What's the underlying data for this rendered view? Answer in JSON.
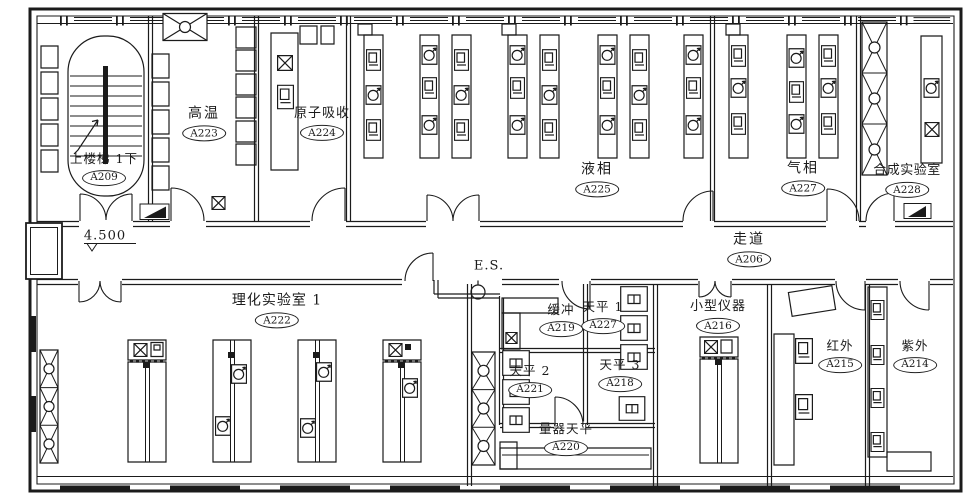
{
  "plan": {
    "colors": {
      "line": "#1b1b1b",
      "background": "#ffffff"
    },
    "annotations": {
      "elevation": "4.500",
      "exit_sign": "E.S."
    },
    "icons": {
      "door": "quarter-arc-swing",
      "stairs": "parallel-tread-run-with-up-arrow",
      "fume_hood_column": "x-hatch-column-with-circles",
      "instrument_dial": "circle-gauge-with-arrow",
      "instrument_box": "small-cabinet-box",
      "balance_table": "box-with-inner-square",
      "floor_drain": "x-box",
      "window_band": "triple-line-glazing-strip",
      "air_handler": "x-rect-with-center-circle",
      "exit_light": "circle-on-stem",
      "elevation_marker": "underline-with-open-triangle"
    },
    "rooms": [
      {
        "name": "上楼梯 1下",
        "code": "A209"
      },
      {
        "name": "高温",
        "code": "A223"
      },
      {
        "name": "原子吸收",
        "code": "A224"
      },
      {
        "name": "液相",
        "code": "A225"
      },
      {
        "name": "气相",
        "code": "A227"
      },
      {
        "name": "合成实验室",
        "code": "A228"
      },
      {
        "name": "走道",
        "code": "A206"
      },
      {
        "name": "理化实验室 1",
        "code": "A222"
      },
      {
        "name": "缓冲",
        "code": "A219"
      },
      {
        "name": "天平 1",
        "code": "A227"
      },
      {
        "name": "天平 2",
        "code": "A221"
      },
      {
        "name": "天平 3",
        "code": "A218"
      },
      {
        "name": "量器天平",
        "code": "A220"
      },
      {
        "name": "小型仪器",
        "code": "A216"
      },
      {
        "name": "红外",
        "code": "A215"
      },
      {
        "name": "紫外",
        "code": "A214"
      }
    ]
  }
}
